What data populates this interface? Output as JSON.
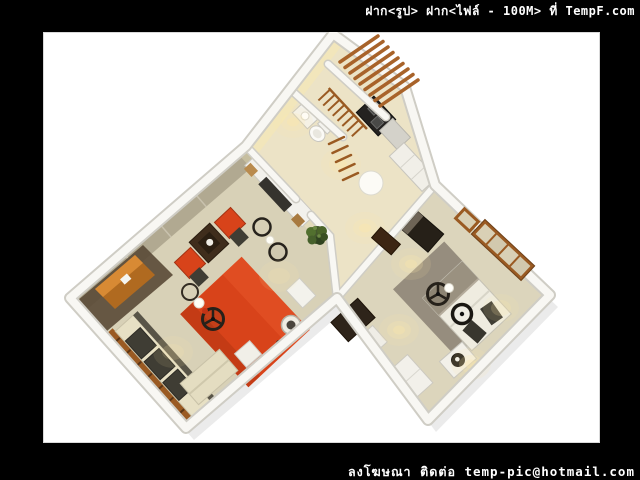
{
  "window": {
    "width": 640,
    "height": 480
  },
  "watermarks": {
    "top": "ฝาก<รูป> ฝาก<ไฟล์ - 100M> ที่ TempF.com",
    "bottom": "ลงโฆษณา ติดต่อ temp-pic@hotmail.com"
  },
  "photo": {
    "subject": "3D isometric cutaway render of a one-bedroom apartment floor plan",
    "rooms": [
      "living-room",
      "kitchen-bathroom-hall",
      "balcony-with-pergola",
      "bedroom"
    ],
    "furniture": [
      "tv-sideboard",
      "red-area-rug",
      "cream-sofa",
      "wood-slat-bench",
      "red-armchairs",
      "dark-coffee-table",
      "round-side-tables",
      "ceiling-fans",
      "sphere-lamps",
      "potted-plant",
      "orange-desk",
      "kitchen-hob",
      "toilet",
      "wash-basin",
      "round-white-mat",
      "hall-counter",
      "double-bed",
      "dark-pillows",
      "nightstand",
      "wall-picture-frames",
      "dark-wardrobe",
      "white-closet"
    ],
    "palette": {
      "frame_black": "#000000",
      "canvas_white": "#ffffff",
      "wall_face": "#f8f7f3",
      "wall_edge": "#cfcdc5",
      "floor_living": "#d8d1b7",
      "floor_hall": "#ece3c6",
      "floor_bedroom": "#dcd5bc",
      "tile_grey": "#aaa28b",
      "dark_wood_floor": "#5a4936",
      "rug_red": "#d8431a",
      "sofa_cream": "#e7e0c4",
      "cushion_dark": "#3f3d34",
      "wood_brown": "#9a5a22",
      "pergola_brown": "#a8632a",
      "carpet_taupe": "#91897a",
      "bed_white": "#efece0",
      "blanket_taupe": "#9a9180",
      "fan_dark": "#26211a",
      "plant_green": "#45582e",
      "light_warm": "#ffe9a8",
      "watermark_text": "#ffffff"
    }
  }
}
